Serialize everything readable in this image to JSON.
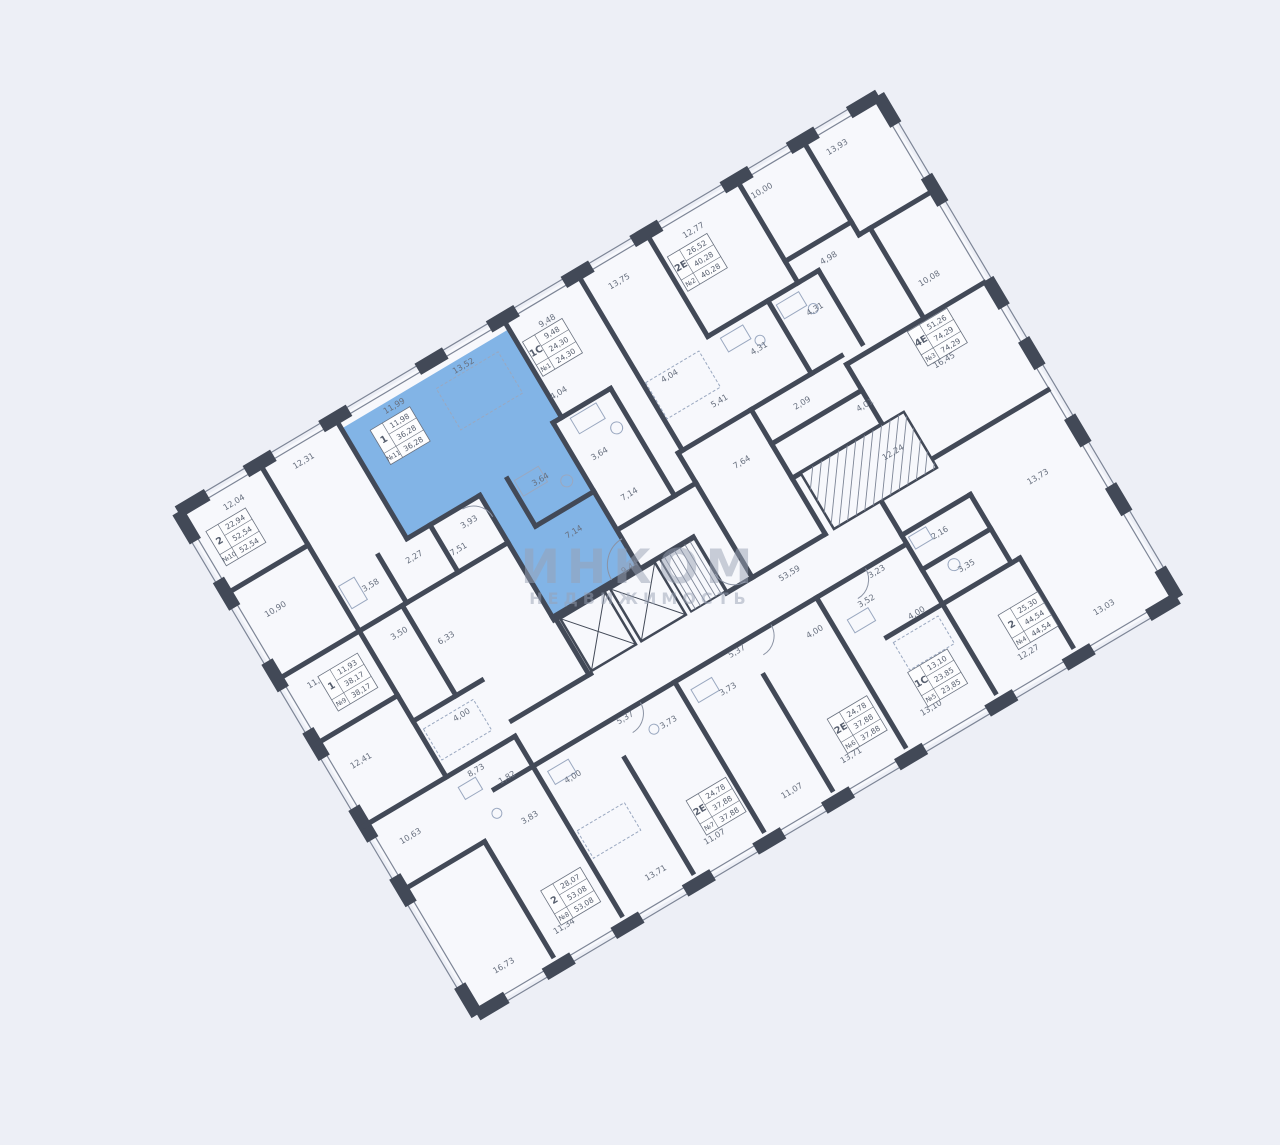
{
  "watermark": {
    "line1": "ИНКОМ",
    "line2": "НЕДВИЖИМОСТЬ"
  },
  "colors": {
    "background": "#edeff6",
    "wall": "#424957",
    "thin_line": "#7d8596",
    "fixture": "#9aa8c0",
    "text": "#68707f",
    "highlight": "#82b4e6",
    "watermark": "#98a1b4",
    "label_box_bg": "#fdfdfe"
  },
  "highlighted_apartment": {
    "number": "№11",
    "type": "1",
    "living_area": "11,98",
    "total_area": "36,28"
  },
  "apartments": [
    {
      "number": "№1",
      "type": "1С",
      "living_area": "9,48",
      "total_area": "24,30",
      "highlighted": false
    },
    {
      "number": "№2",
      "type": "2Е",
      "living_area": "26,52",
      "total_area": "40,28",
      "highlighted": false
    },
    {
      "number": "№3",
      "type": "4Е",
      "living_area": "51,26",
      "total_area": "74,29",
      "highlighted": false
    },
    {
      "number": "№4",
      "type": "2",
      "living_area": "25,30",
      "total_area": "44,54",
      "highlighted": false
    },
    {
      "number": "№5",
      "type": "1С",
      "living_area": "13,10",
      "total_area": "23,85",
      "highlighted": false
    },
    {
      "number": "№6",
      "type": "2Е",
      "living_area": "24,78",
      "total_area": "37,88",
      "highlighted": false
    },
    {
      "number": "№7",
      "type": "2Е",
      "living_area": "24,78",
      "total_area": "37,88",
      "highlighted": false
    },
    {
      "number": "№8",
      "type": "2",
      "living_area": "28,07",
      "total_area": "53,08",
      "highlighted": false
    },
    {
      "number": "№9",
      "type": "1",
      "living_area": "11,93",
      "total_area": "38,17",
      "highlighted": false
    },
    {
      "number": "№10",
      "type": "2",
      "living_area": "22,94",
      "total_area": "52,54",
      "highlighted": false
    },
    {
      "number": "№11",
      "type": "1",
      "living_area": "11,98",
      "total_area": "36,28",
      "highlighted": true
    }
  ],
  "dimension_labels": [
    "12,04",
    "12,31",
    "11,99",
    "13,52",
    "9,48",
    "13,75",
    "12,77",
    "10,00",
    "13,93",
    "4,98",
    "10,08",
    "4,31",
    "4,31",
    "16,45",
    "4,04",
    "4,04",
    "5,41",
    "2,09",
    "4,01",
    "7,64",
    "12,24",
    "3,64",
    "3,64",
    "7,14",
    "7,14",
    "3,93",
    "2,27",
    "7,51",
    "3,58",
    "10,90",
    "3,50",
    "6,33",
    "11,93",
    "4,00",
    "12,41",
    "53,59",
    "9,44",
    "8,73",
    "1,82",
    "3,83",
    "10,63",
    "4,00",
    "5,37",
    "3,73",
    "5,37",
    "3,73",
    "4,00",
    "3,52",
    "3,23",
    "4,00",
    "2,16",
    "3,35",
    "13,73",
    "16,73",
    "11,34",
    "13,71",
    "11,07",
    "11,07",
    "13,71",
    "13,10",
    "12,27",
    "13,03"
  ]
}
